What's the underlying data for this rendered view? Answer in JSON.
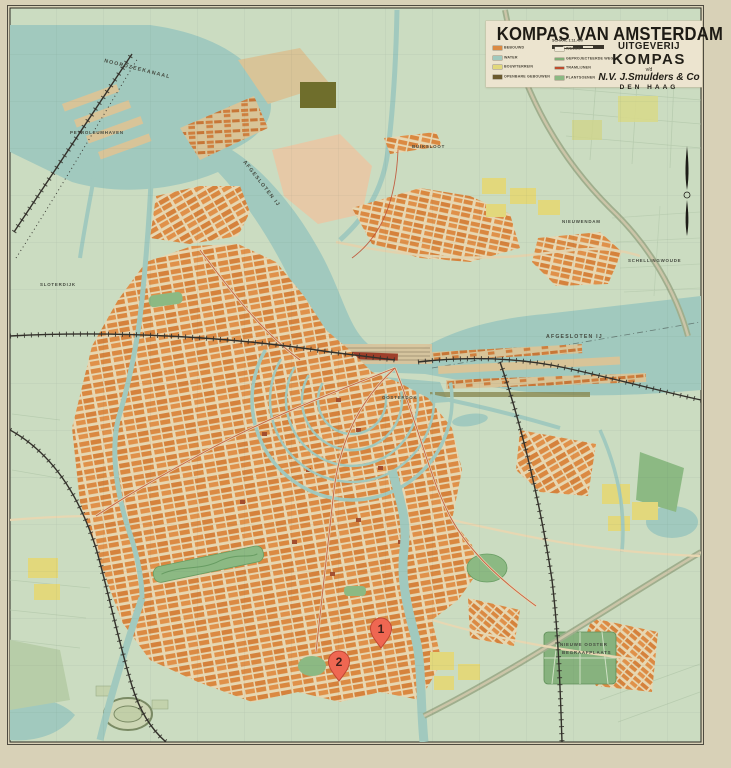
{
  "map": {
    "title_block": {
      "title": "KOMPAS VAN AMSTERDAM",
      "scale_label": "SCHAAL 1:11.400",
      "publisher": {
        "line1": "UITGEVERIJ",
        "line2": "KOMPAS",
        "line3": "v/d",
        "line4": "N.V. J.Smulders & Co",
        "line5": "DEN HAAG"
      },
      "legend": {
        "items": [
          {
            "label": "BEBOUWD",
            "color": "#db8a43"
          },
          {
            "label": "WATER",
            "color": "#a1c9be"
          },
          {
            "label": "BOUWTERREIN",
            "color": "#e2d87c"
          },
          {
            "label": "OPENBARE GEBOUWEN",
            "color": "#6b5a2e"
          },
          {
            "label": "WEGEN",
            "color": "#f0ead8"
          },
          {
            "label": "GEPROJECTEERDE WEGEN",
            "color": "#7fae76"
          },
          {
            "label": "TRAMLIJNEN",
            "color": "#bf4b2e"
          },
          {
            "label": "PLANTSOENEN",
            "color": "#8cb983"
          }
        ]
      }
    },
    "labels": [
      {
        "text": "NOORDZEEKANAAL"
      },
      {
        "text": "AFGESLOTEN IJ"
      },
      {
        "text": "AFGESLOTEN IJ"
      },
      {
        "text": "SLOTERDIJK"
      },
      {
        "text": "BUIKSLOOT"
      },
      {
        "text": "NIEUWENDAM"
      },
      {
        "text": "SCHELLINGWOUDE"
      },
      {
        "text": "OOSTERDOK"
      },
      {
        "text": "PETROLEUMHAVEN"
      },
      {
        "text": "NIEUWE OOSTER"
      },
      {
        "text": "BEGRAAFPLAATS"
      }
    ],
    "markers": [
      {
        "number": "1"
      },
      {
        "number": "2"
      }
    ],
    "colors": {
      "paper": "#d8d1b7",
      "land": "#cbdcc1",
      "water": "#a1c9be",
      "city_block": "#db8a43",
      "street": "#e7d7b2",
      "park": "#8cb983",
      "pin": "#ef6752"
    }
  }
}
